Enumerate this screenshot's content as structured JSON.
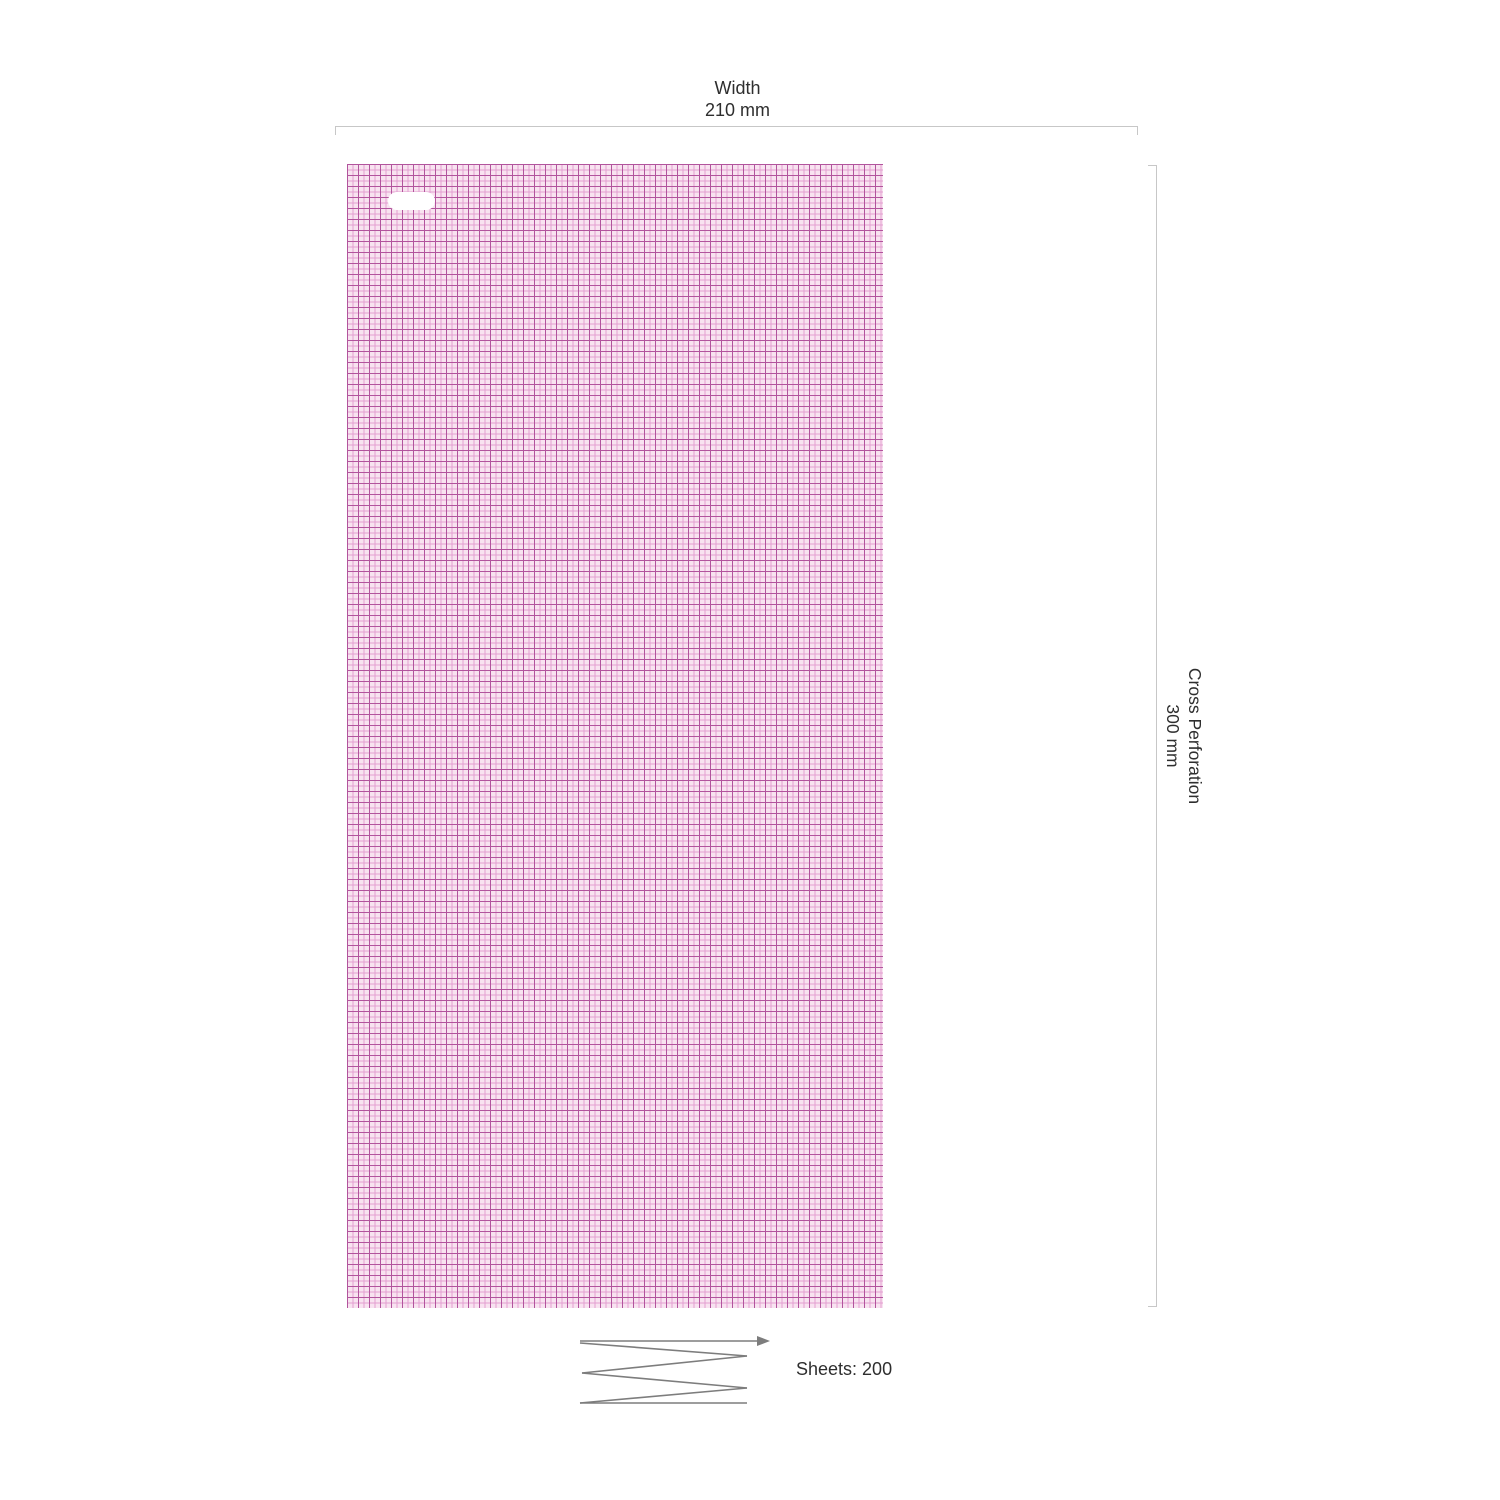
{
  "dimensions": {
    "width": {
      "label": "Width",
      "value": "210 mm"
    },
    "cross_perforation": {
      "label": "Cross Perforation",
      "value": "300 mm"
    }
  },
  "fold": {
    "sheets_label": "Sheets: 200",
    "icon": "zigzag-fold-arrow-icon"
  },
  "paper": {
    "kind": "ecg-grid-paper",
    "slot_icon": "sprocket-slot"
  },
  "colors": {
    "page_bg": "#ffffff",
    "grid_bg": "#f8e3f0",
    "grid_minor": "#e39fd1",
    "grid_major": "#b2549d",
    "dimension_line": "#c7c7c7",
    "fold_line": "#7d7d7d",
    "text": "#2e2e2e",
    "slot": "#ffffff"
  }
}
